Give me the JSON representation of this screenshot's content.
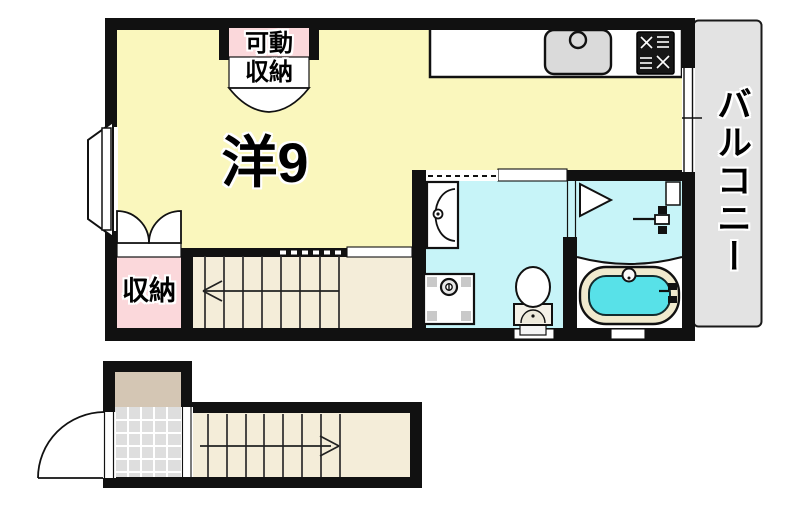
{
  "labels": {
    "main_room": "洋9",
    "movable_storage_top": "可動",
    "movable_storage_bottom": "収納",
    "storage": "収納",
    "balcony": "バルコニー"
  },
  "colors": {
    "room_yellow": "#FAF7BD",
    "wet_area_cyan": "#C7F4F8",
    "tub_water": "#58E1E8",
    "tub_rim": "#F0EACE",
    "closet_pink": "#FBD8DB",
    "stairs_beige": "#F4EDD9",
    "balcony_gray": "#E3E3E3",
    "tile_gray": "#DEDEDE",
    "porch_tan": "#D4C6B4",
    "wall_black": "#111111",
    "sink_gray": "#DADADA"
  },
  "fixtures": [
    {
      "name": "kitchen-sink"
    },
    {
      "name": "gas-stove"
    },
    {
      "name": "vanity-sink"
    },
    {
      "name": "washing-machine-pan"
    },
    {
      "name": "toilet"
    },
    {
      "name": "bathtub"
    },
    {
      "name": "bath-shower-faucet"
    },
    {
      "name": "bay-window"
    },
    {
      "name": "balcony-window"
    },
    {
      "name": "movable-storage-closet"
    },
    {
      "name": "storage-closet"
    },
    {
      "name": "staircase-upper"
    },
    {
      "name": "staircase-lower"
    },
    {
      "name": "entrance-door"
    }
  ]
}
